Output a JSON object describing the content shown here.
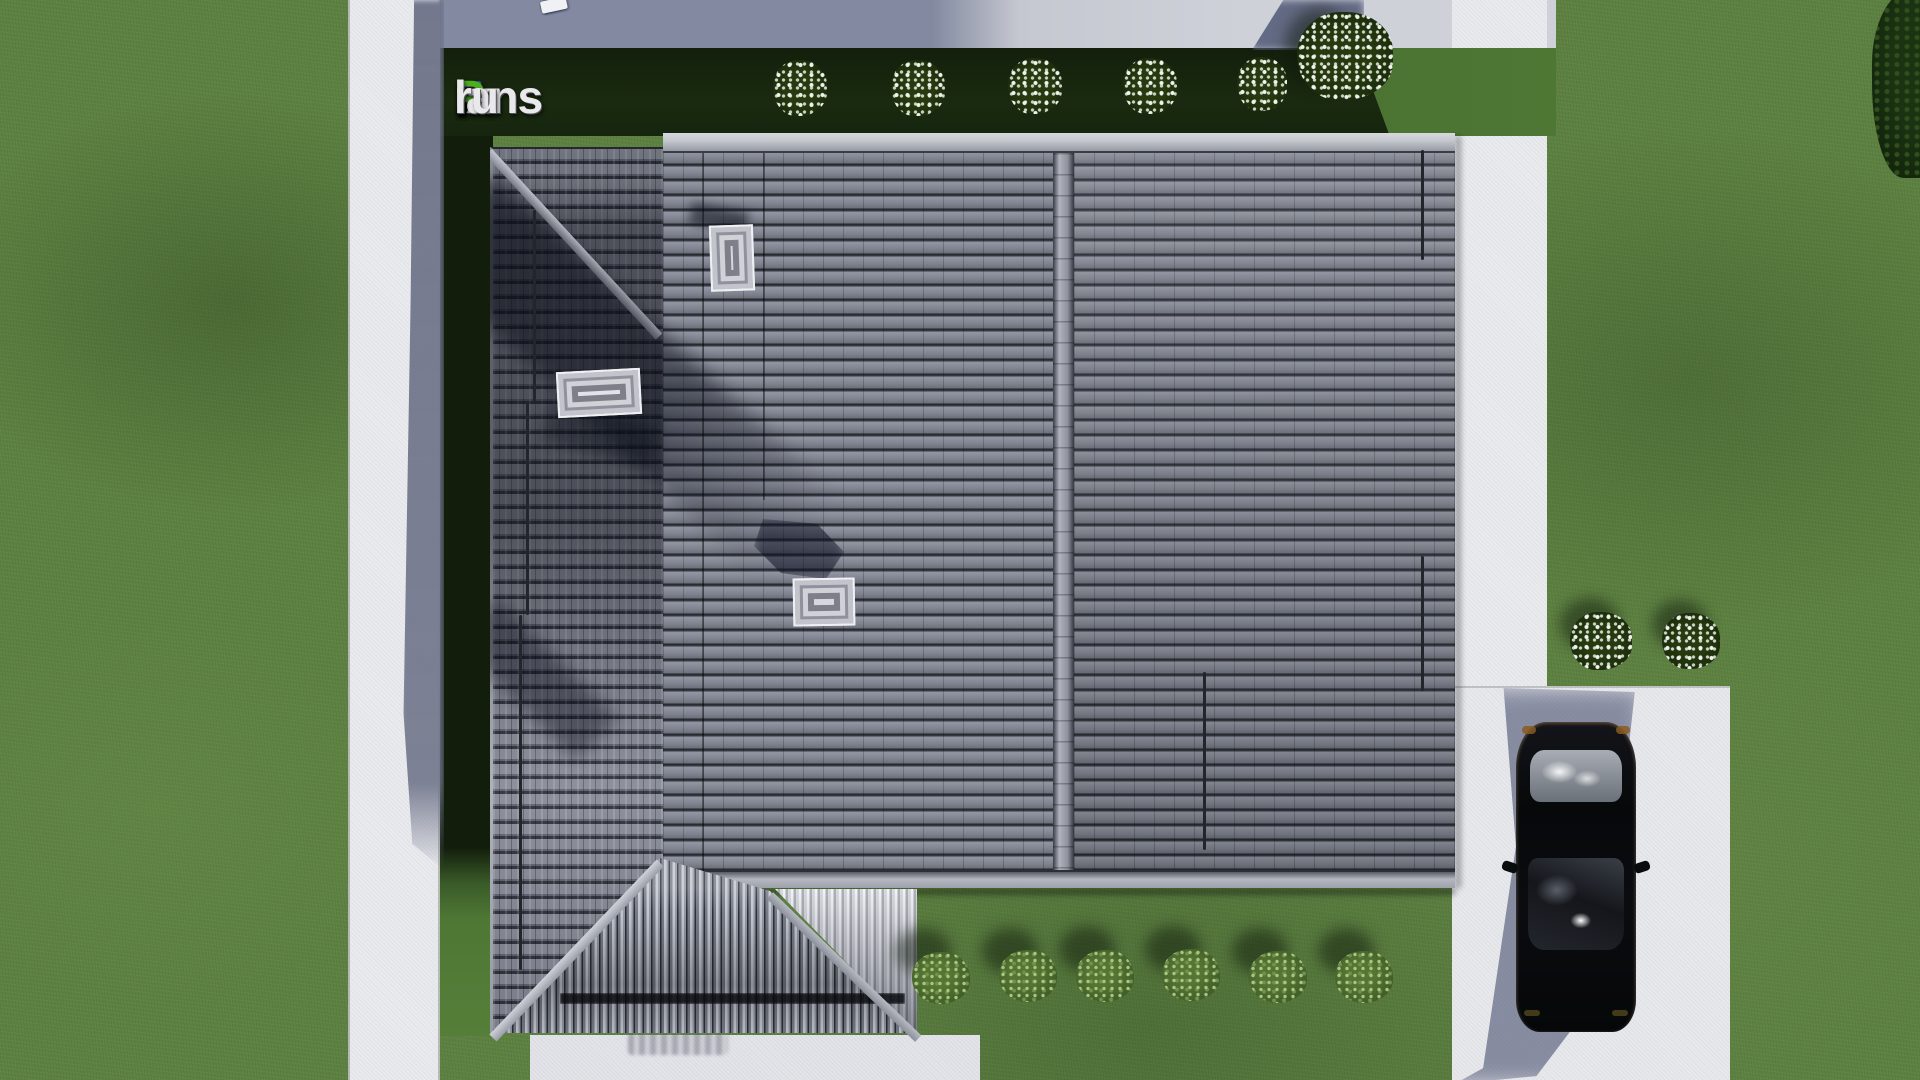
{
  "watermark": {
    "segments": [
      {
        "text": "F",
        "color": "#2b6fe0"
      },
      {
        "text": "ix",
        "color": "#e9e9ec"
      },
      {
        "text": "P",
        "color": "#4caf1e"
      },
      {
        "text": "lans",
        "color": "#e9e9ec"
      },
      {
        "text": ".",
        "color": "#2b6fe0"
      },
      {
        "text": "ru",
        "color": "#e9e9ec"
      }
    ],
    "full_text": "FixPlans.ru"
  },
  "colors": {
    "grass": "#5d8141",
    "grass-shadow": "#15220f",
    "concrete": "#e9eaee",
    "concrete-shadow": "#8289a0",
    "roof-tile": "#7e828e",
    "roof-tile-dark": "#24262e",
    "roof-wing": "#5e626e",
    "ridge": "#8e929d",
    "fascia": "#b4b7c0",
    "skylight": "#d7d8dd",
    "porch-rib": "#9298a4",
    "car-body": "#0a0b0f",
    "car-shadow": "#384264",
    "taillight-amber": "#8a5a20",
    "flower-white": "#eef2ec",
    "bush-green": "#567534",
    "logo-blue": "#2b6fe0",
    "logo-green": "#4caf1e",
    "logo-white": "#e9e9ec"
  },
  "scene": {
    "view": "top-down aerial render of a house lot",
    "objects": [
      "tiled hip-gable roof",
      "roof skylights",
      "chimney",
      "porch gable",
      "concrete paths",
      "driveway",
      "black car",
      "flowering bushes",
      "green bushes",
      "lawn"
    ]
  }
}
